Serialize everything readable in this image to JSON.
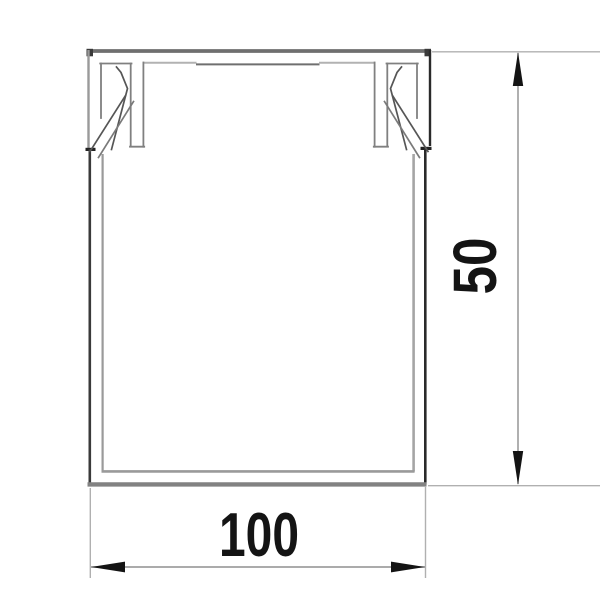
{
  "drawing": {
    "dimensions": {
      "width_label": "100",
      "height_label": "50"
    },
    "icons": {
      "width_arrow_left": "arrowhead-left-icon",
      "width_arrow_right": "arrowhead-right-icon",
      "height_arrow_up": "arrowhead-up-icon",
      "height_arrow_down": "arrowhead-down-icon"
    },
    "colors": {
      "background": "#ffffff",
      "outline_dark": "#2a2a2a",
      "outline_gray": "#6f6f6f",
      "outline_light": "#9a9a9a",
      "inner_line": "#9a9a9a",
      "clip_line": "#565656",
      "dimension_line": "#8f8f8f",
      "extension_line": "#b0b0b0",
      "dimension_text": "#141414"
    }
  }
}
